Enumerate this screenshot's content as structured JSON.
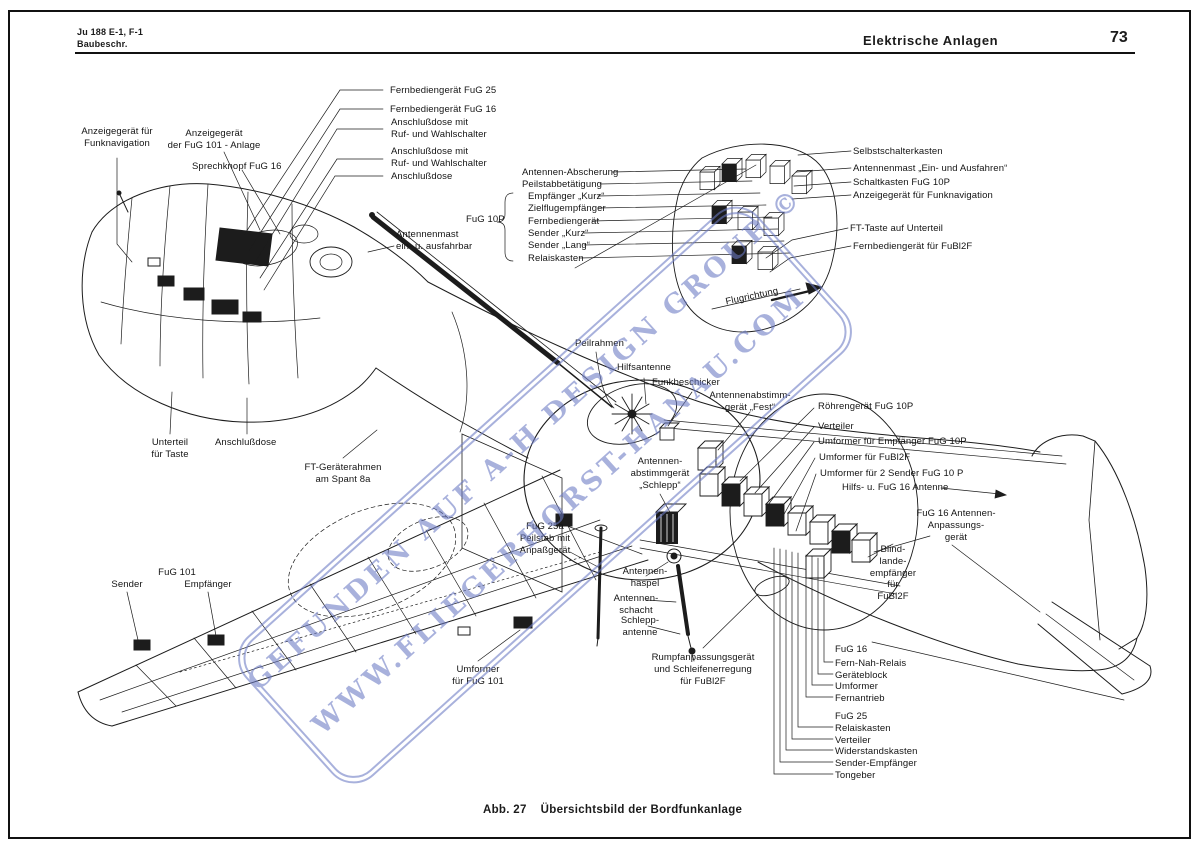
{
  "page": {
    "header": {
      "doc_ref_line1": "Ju 188 E-1, F-1",
      "doc_ref_line2": "Baubeschr.",
      "section_title": "Elektrische Anlagen",
      "page_number": "73"
    },
    "caption": {
      "figure_no": "Abb. 27",
      "title": "Übersichtsbild der Bordfunkanlage"
    },
    "colors": {
      "ink": "#1c1c1c",
      "paper": "#ffffff",
      "watermark": "#6b79c4"
    }
  },
  "watermark": {
    "line1": "GEFUNDEN AUF A-H DESIGN GROUP ©",
    "line2": "WWW.FLIEGERHORST-HANAU.COM"
  },
  "diagram": {
    "labels": [
      {
        "text": "Fernbediengerät FuG 25",
        "x": 390,
        "y": 85,
        "align": "left"
      },
      {
        "text": "Fernbediengerät FuG 16",
        "x": 390,
        "y": 104,
        "align": "left"
      },
      {
        "text": "Anschlußdose mit\nRuf- und Wahlschalter",
        "x": 391,
        "y": 117,
        "align": "left"
      },
      {
        "text": "Anschlußdose mit\nRuf- und Wahlschalter",
        "x": 391,
        "y": 146,
        "align": "left"
      },
      {
        "text": "Anschlußdose",
        "x": 391,
        "y": 171,
        "align": "left"
      },
      {
        "text": "Anzeigegerät für\nFunknavigation",
        "x": 117,
        "y": 126,
        "align": "center"
      },
      {
        "text": "Anzeigegerät\nder FuG 101 - Anlage",
        "x": 214,
        "y": 128,
        "align": "center"
      },
      {
        "text": "Sprechknopf FuG 16",
        "x": 192,
        "y": 161,
        "align": "left"
      },
      {
        "text": "Antennen-Abscherung",
        "x": 522,
        "y": 167,
        "align": "left"
      },
      {
        "text": "Peilstabbetätigung",
        "x": 522,
        "y": 179,
        "align": "left"
      },
      {
        "text": "Empfänger „Kurz“",
        "x": 528,
        "y": 191,
        "align": "left"
      },
      {
        "text": "Zielflugempfänger",
        "x": 528,
        "y": 203,
        "align": "left"
      },
      {
        "text": "Fernbediengerät",
        "x": 528,
        "y": 216,
        "align": "left"
      },
      {
        "text": "Sender „Kurz“",
        "x": 528,
        "y": 228,
        "align": "left"
      },
      {
        "text": "Sender „Lang“",
        "x": 528,
        "y": 240,
        "align": "left"
      },
      {
        "text": "Relaiskasten",
        "x": 528,
        "y": 253,
        "align": "left"
      },
      {
        "text": "FuG 10P",
        "x": 466,
        "y": 214,
        "align": "left"
      },
      {
        "text": "Antennenmast\nein- u. ausfahrbar",
        "x": 396,
        "y": 229,
        "align": "left"
      },
      {
        "text": "Selbstschalterkasten",
        "x": 853,
        "y": 146,
        "align": "left"
      },
      {
        "text": "Antennenmast „Ein- und Ausfahren“",
        "x": 853,
        "y": 163,
        "align": "left"
      },
      {
        "text": "Schaltkasten FuG 10P",
        "x": 853,
        "y": 177,
        "align": "left"
      },
      {
        "text": "Anzeigegerät für Funknavigation",
        "x": 853,
        "y": 190,
        "align": "left"
      },
      {
        "text": "FT-Taste auf Unterteil",
        "x": 850,
        "y": 223,
        "align": "left"
      },
      {
        "text": "Fernbediengerät für FuBl2F",
        "x": 853,
        "y": 241,
        "align": "left"
      },
      {
        "text": "Flugrichtung",
        "x": 752,
        "y": 291,
        "align": "center",
        "rotate": -12
      },
      {
        "text": "Peilrahmen",
        "x": 575,
        "y": 338,
        "align": "left"
      },
      {
        "text": "Hilfsantenne",
        "x": 617,
        "y": 362,
        "align": "left"
      },
      {
        "text": "Funkbeschicker",
        "x": 652,
        "y": 377,
        "align": "left"
      },
      {
        "text": "Antennenabstimm-\ngerät „Fest“",
        "x": 750,
        "y": 390,
        "align": "center"
      },
      {
        "text": "Röhrengerät FuG 10P",
        "x": 818,
        "y": 401,
        "align": "left"
      },
      {
        "text": "Verteiler",
        "x": 818,
        "y": 421,
        "align": "left"
      },
      {
        "text": "Umformer für Empfänger FuG 10P",
        "x": 818,
        "y": 436,
        "align": "left"
      },
      {
        "text": "Umformer für FuBl2F",
        "x": 819,
        "y": 452,
        "align": "left"
      },
      {
        "text": "Umformer für 2 Sender FuG 10 P",
        "x": 820,
        "y": 468,
        "align": "left"
      },
      {
        "text": "Hilfs- u. FuG 16 Antenne",
        "x": 842,
        "y": 482,
        "align": "left"
      },
      {
        "text": "FuG 16 Antennen-\nAnpassungs-\ngerät",
        "x": 956,
        "y": 508,
        "align": "center"
      },
      {
        "text": "Blind-\nlande-\nempfänger\nfür\nFuBl2F",
        "x": 893,
        "y": 544,
        "align": "center"
      },
      {
        "text": "Unterteil\nfür Taste",
        "x": 170,
        "y": 437,
        "align": "center"
      },
      {
        "text": "Anschlußdose",
        "x": 215,
        "y": 437,
        "align": "left"
      },
      {
        "text": "FT-Geräterahmen\nam Spant 8a",
        "x": 343,
        "y": 462,
        "align": "center"
      },
      {
        "text": "Antennen-\nabstimmgerät\n„Schlepp“",
        "x": 660,
        "y": 456,
        "align": "center"
      },
      {
        "text": "FuG 25a\nPeilstab mit\nAnpaßgerät",
        "x": 545,
        "y": 521,
        "align": "center"
      },
      {
        "text": "Sender",
        "x": 127,
        "y": 579,
        "align": "center"
      },
      {
        "text": "FuG 101",
        "x": 177,
        "y": 567,
        "align": "center"
      },
      {
        "text": "Empfänger",
        "x": 208,
        "y": 579,
        "align": "center"
      },
      {
        "text": "Umformer\nfür FuG 101",
        "x": 478,
        "y": 664,
        "align": "center"
      },
      {
        "text": "Antennen-\nhaspel",
        "x": 645,
        "y": 566,
        "align": "center"
      },
      {
        "text": "Antennen-\nschacht",
        "x": 636,
        "y": 593,
        "align": "center"
      },
      {
        "text": "Schlepp-\nantenne",
        "x": 640,
        "y": 615,
        "align": "center"
      },
      {
        "text": "Rumpfanpassungsgerät\nund Schleifenerregung\nfür FuBl2F",
        "x": 703,
        "y": 652,
        "align": "center"
      },
      {
        "text": "FuG 16",
        "x": 835,
        "y": 644,
        "align": "left"
      },
      {
        "text": "Fern-Nah-Relais",
        "x": 835,
        "y": 658,
        "align": "left"
      },
      {
        "text": "Geräteblock",
        "x": 835,
        "y": 670,
        "align": "left"
      },
      {
        "text": "Umformer",
        "x": 835,
        "y": 681,
        "align": "left"
      },
      {
        "text": "Fernantrieb",
        "x": 835,
        "y": 693,
        "align": "left"
      },
      {
        "text": "FuG 25",
        "x": 835,
        "y": 711,
        "align": "left"
      },
      {
        "text": "Relaiskasten",
        "x": 835,
        "y": 723,
        "align": "left"
      },
      {
        "text": "Verteiler",
        "x": 835,
        "y": 735,
        "align": "left"
      },
      {
        "text": "Widerstandskasten",
        "x": 835,
        "y": 746,
        "align": "left"
      },
      {
        "text": "Sender-Empfänger",
        "x": 835,
        "y": 758,
        "align": "left"
      },
      {
        "text": "Tongeber",
        "x": 835,
        "y": 770,
        "align": "left"
      }
    ]
  }
}
